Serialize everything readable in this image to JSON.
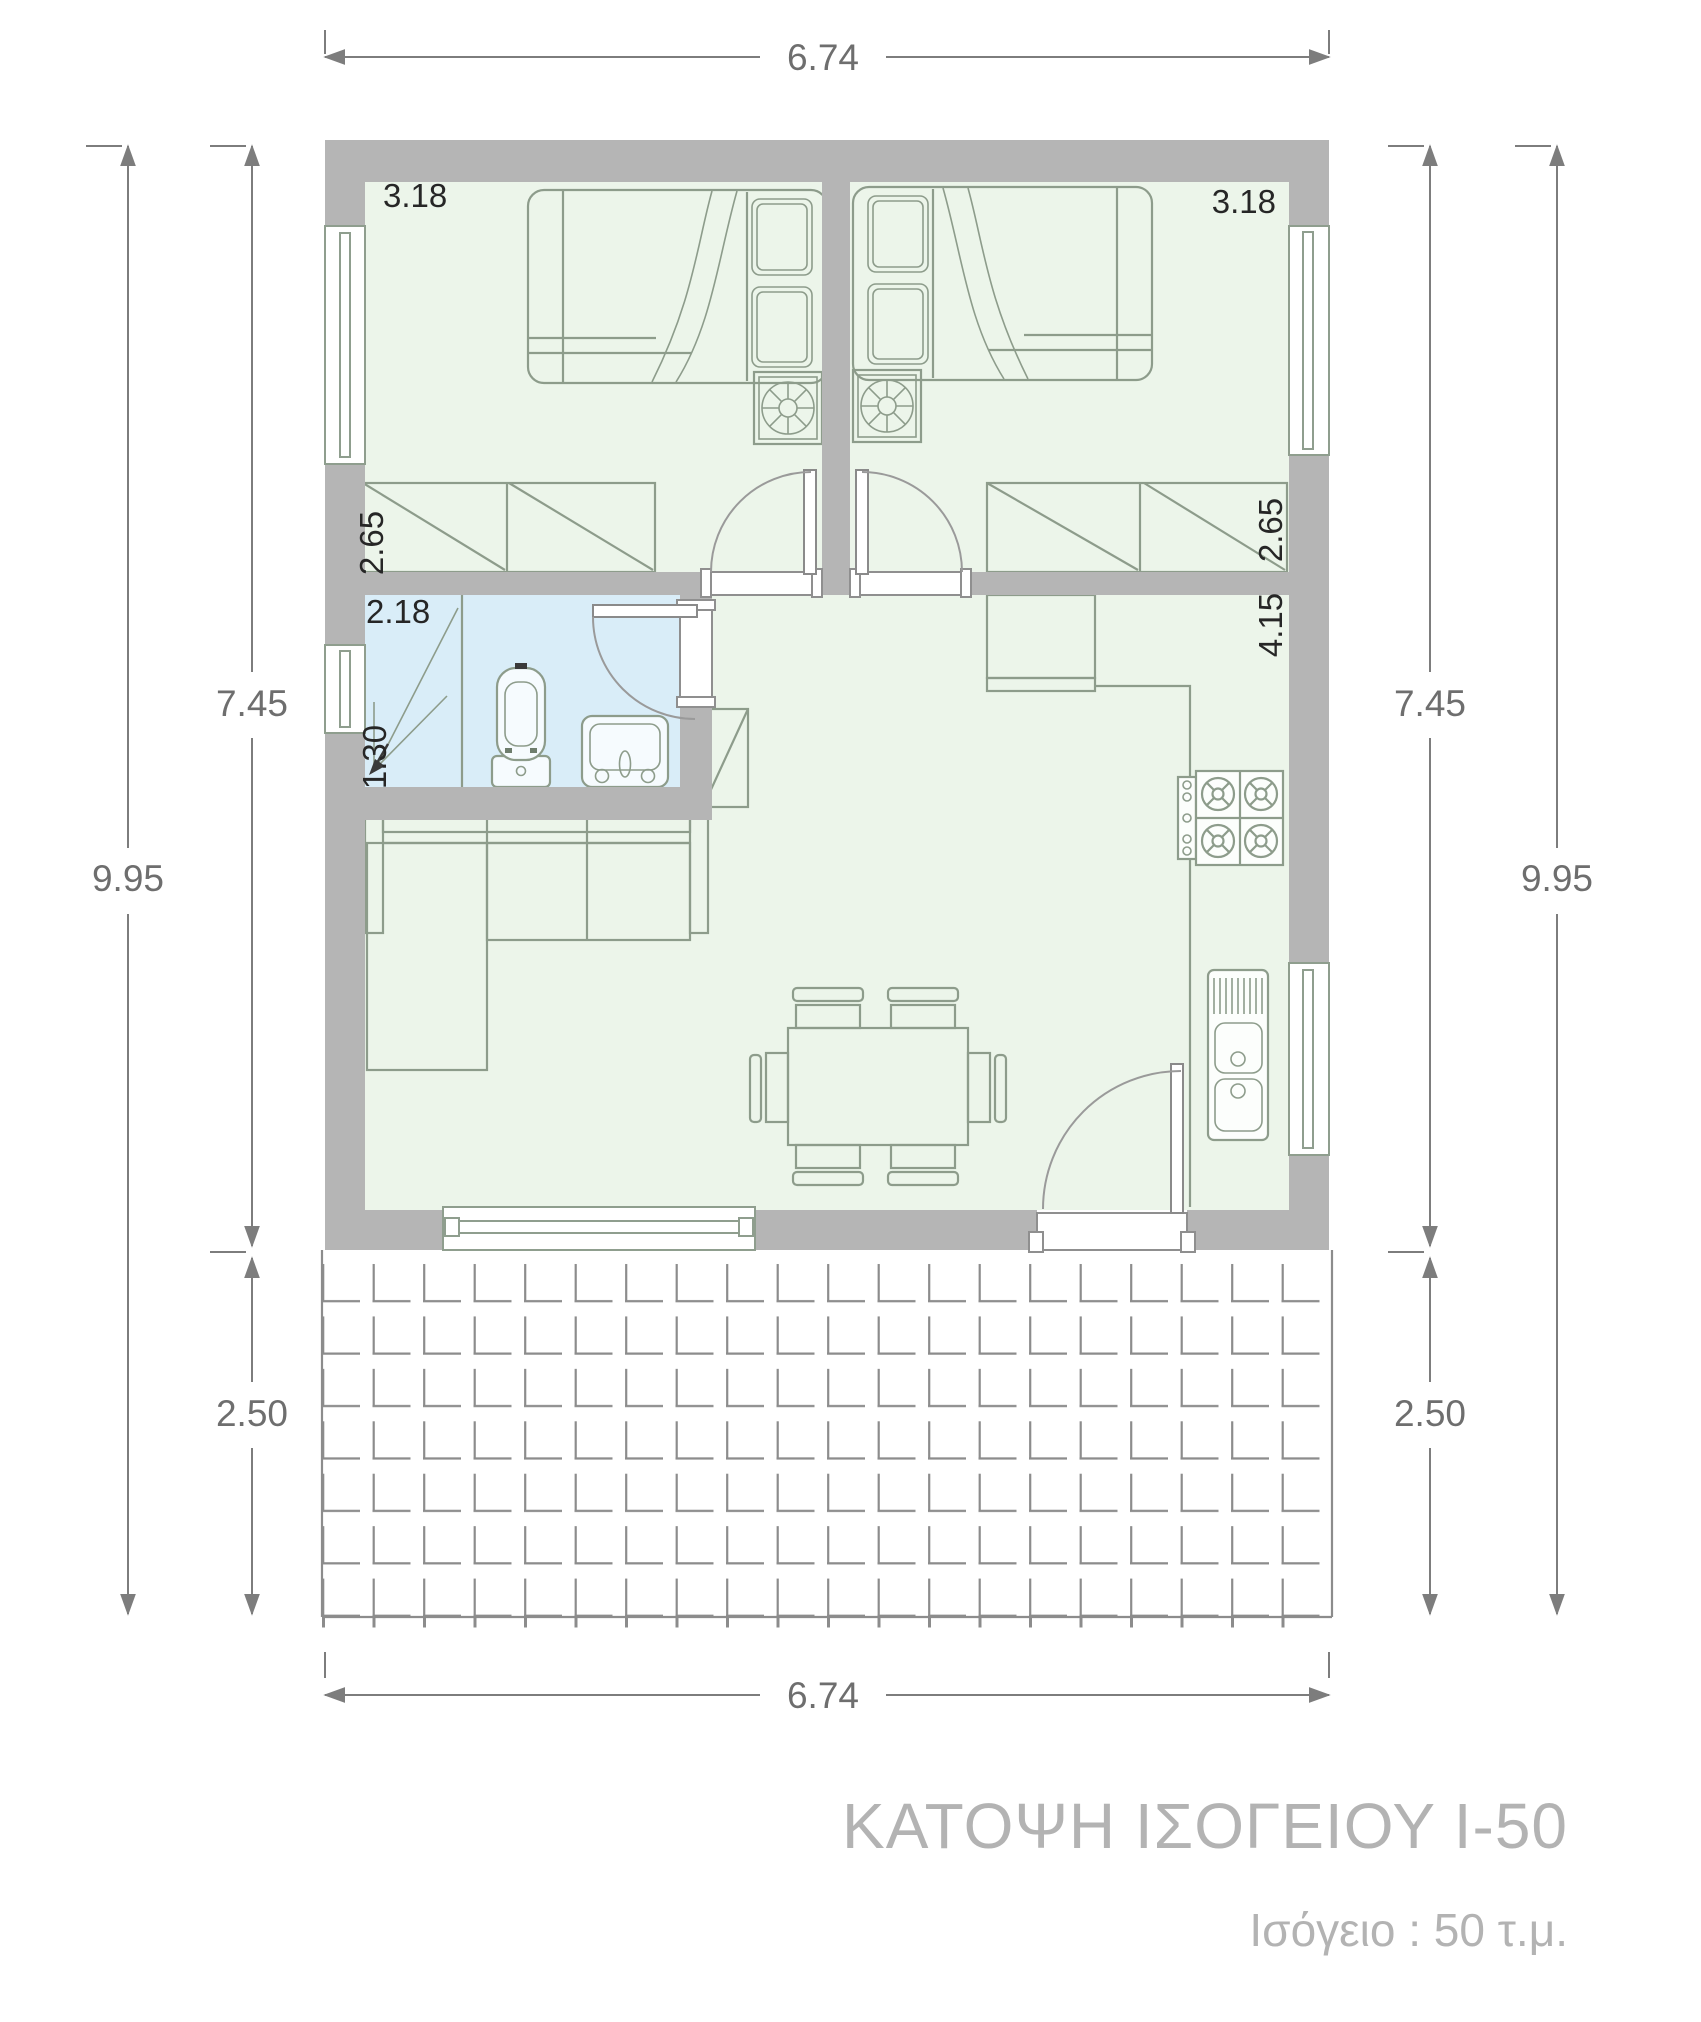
{
  "plan": {
    "title": "ΚΑΤΟΨΗ ΙΣΟΓΕΙΟΥ Ι-50",
    "subtitle": "Ισόγειο :  50 τ.μ."
  },
  "dimensions": {
    "top": "6.74",
    "bottom": "6.74",
    "left": {
      "upper": "7.45",
      "total": "9.95",
      "lower": "2.50"
    },
    "right": {
      "upper": "7.45",
      "total": "9.95",
      "lower": "2.50"
    }
  },
  "room_labels": {
    "bedroom1_width": "3.18",
    "bedroom2_width": "3.18",
    "bedroom1_depth": "2.65",
    "bedroom2_depth": "2.65",
    "bathroom_width": "2.18",
    "bathroom_depth": "1.30",
    "kitchen_depth": "4.15"
  },
  "icons": {
    "nightstand_fan": "fan-icon",
    "stove_burner": "gas-burner-icon"
  },
  "colors": {
    "wall": "#b5b5b5",
    "floor": "#ecf5ea",
    "bathroom_floor": "#d9edf8",
    "furniture_line": "#8d9c8b",
    "dimension_line": "#7d7d7d",
    "room_label": "#262626",
    "title_text": "#b3b3b3",
    "tile_line": "#8c8c8c"
  }
}
